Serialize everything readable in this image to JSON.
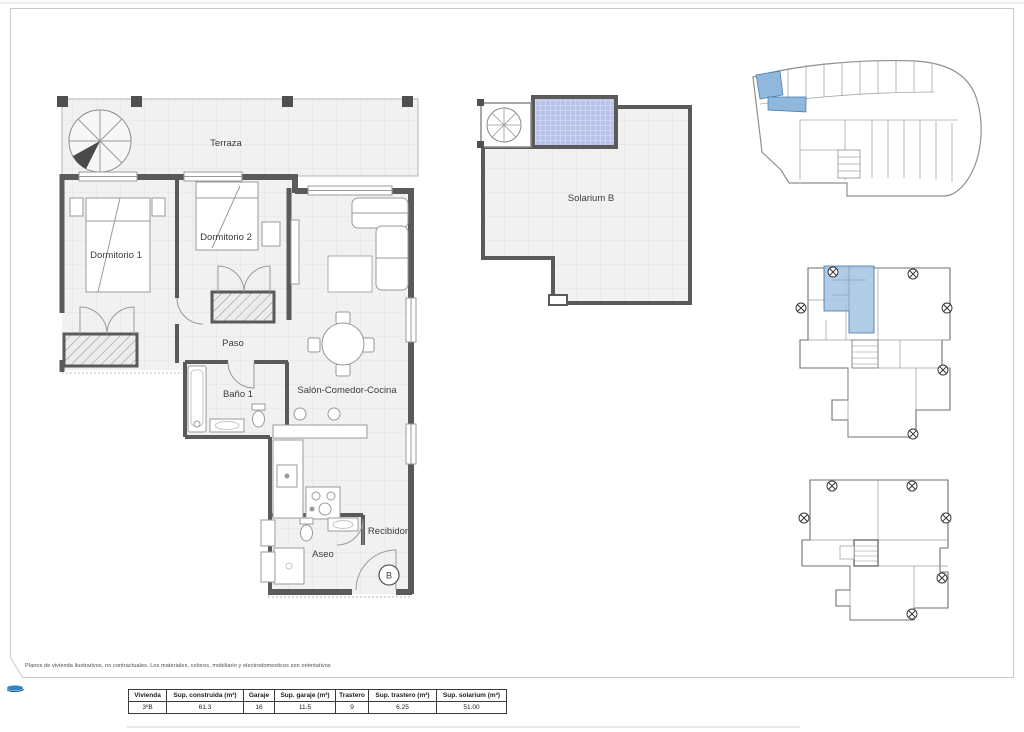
{
  "page": {
    "disclaimer": "Planos de vivienda ilustrativos, no contractuales. Los materiales, colores, mobiliario y electrodomesticos son orientativos",
    "entrance_badge": "B"
  },
  "colors": {
    "wall": "#5a5a5a",
    "floor_fill": "#f1f1f1",
    "floor_grid": "#e3e3e3",
    "pergola_blue": "#b9c3ea",
    "keyplan_highlight_blue": "#a9c6e4",
    "garage_highlight_blue": "#8fb8dc",
    "frame_gray": "#c8c8c8",
    "logo_blue": "#2f86c0"
  },
  "main_plan": {
    "rooms": [
      {
        "label": "Terraza"
      },
      {
        "label": "Dormitorio 1"
      },
      {
        "label": "Dormitorio 2"
      },
      {
        "label": "Paso"
      },
      {
        "label": "Baño 1"
      },
      {
        "label": "Salón-Comedor-Cocina"
      },
      {
        "label": "Aseo"
      },
      {
        "label": "Recibidor"
      }
    ]
  },
  "solarium_plan": {
    "label": "Solarium B"
  },
  "table": {
    "headers": [
      "Vivienda",
      "Sup. construida (m²)",
      "Garaje",
      "Sup. garaje (m²)",
      "Trastero",
      "Sup. trastero (m²)",
      "Sup. solarium (m²)"
    ],
    "row": [
      "3ºB",
      "61.3",
      "16",
      "11.5",
      "9",
      "6.25",
      "51.00"
    ]
  }
}
